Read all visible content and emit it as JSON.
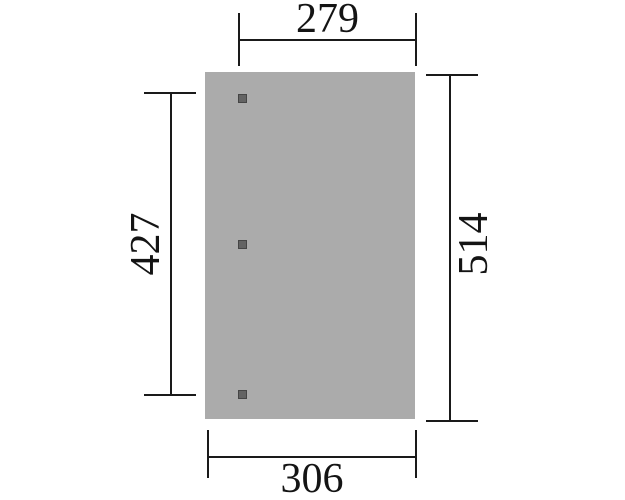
{
  "diagram": {
    "type": "top-view dimension drawing",
    "post_count": 3
  },
  "dimensions": {
    "top": "279",
    "left": "427",
    "right": "514",
    "bottom": "306"
  },
  "colors": {
    "background": "#ffffff",
    "slab_fill": "#ababab",
    "post_fill": "#636363",
    "post_border": "#454545",
    "line": "#1a1a1a",
    "text": "#141414"
  }
}
